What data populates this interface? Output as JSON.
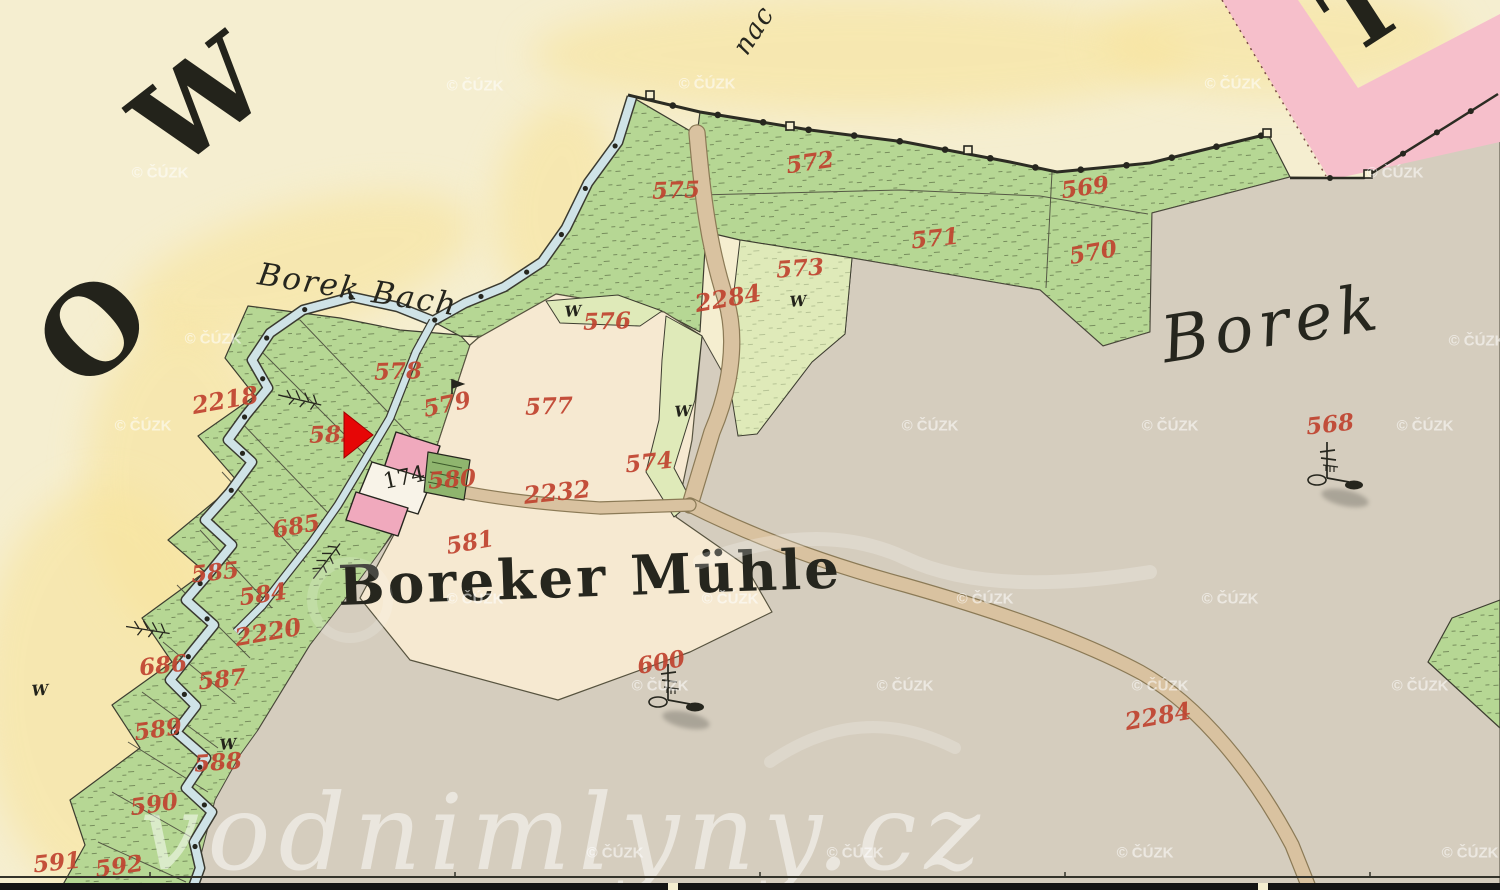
{
  "viewer": {
    "copyright_watermark": {
      "text": "© ČÚZK",
      "positions": [
        [
          475,
          85
        ],
        [
          707,
          83
        ],
        [
          1233,
          83
        ],
        [
          160,
          172
        ],
        [
          1395,
          172
        ],
        [
          213,
          338
        ],
        [
          1477,
          340
        ],
        [
          143,
          425
        ],
        [
          930,
          425
        ],
        [
          1170,
          425
        ],
        [
          1425,
          425
        ],
        [
          475,
          598
        ],
        [
          730,
          598
        ],
        [
          985,
          598
        ],
        [
          1230,
          598
        ],
        [
          660,
          685
        ],
        [
          905,
          685
        ],
        [
          1160,
          685
        ],
        [
          1420,
          685
        ],
        [
          615,
          852
        ],
        [
          855,
          852
        ],
        [
          1145,
          852
        ],
        [
          1470,
          852
        ]
      ]
    },
    "site_watermark": {
      "text": "vodnimlyny.cz",
      "x": 140,
      "y": 832
    },
    "marker": {
      "type": "right-arrow",
      "color": "#e60606",
      "points": [
        [
          344,
          412
        ],
        [
          344,
          458
        ],
        [
          373,
          435
        ]
      ]
    }
  },
  "map": {
    "territory_letters": [
      {
        "t": "O",
        "x": 93,
        "y": 330,
        "r": -44,
        "s": 118
      },
      {
        "t": "W",
        "x": 200,
        "y": 102,
        "r": -38,
        "s": 115
      },
      {
        "t": "T",
        "x": 1363,
        "y": 10,
        "r": -33,
        "s": 95
      }
    ],
    "place_labels": [
      {
        "t": "Borek Bach",
        "x": 358,
        "y": 289,
        "r": 9,
        "s": 31,
        "it": 1,
        "ls": 2
      },
      {
        "t": "nac",
        "x": 753,
        "y": 30,
        "r": -57,
        "s": 27,
        "it": 1,
        "ls": 1
      },
      {
        "t": "Boreker Mühle",
        "x": 590,
        "y": 577,
        "r": -2,
        "s": 55,
        "b": 1,
        "ls": 3
      },
      {
        "t": "Borek",
        "x": 1272,
        "y": 323,
        "r": -9,
        "s": 64,
        "it": 1,
        "ls": 6
      }
    ],
    "house_numbers": [
      {
        "t": "174",
        "x": 404,
        "y": 477,
        "r": -12,
        "s": 22
      }
    ],
    "parcel_numbers": [
      {
        "t": "2218",
        "x": 225,
        "y": 400,
        "r": -10
      },
      {
        "t": "572",
        "x": 810,
        "y": 162,
        "r": -8
      },
      {
        "t": "575",
        "x": 676,
        "y": 190,
        "r": -2
      },
      {
        "t": "569",
        "x": 1085,
        "y": 187,
        "r": -8
      },
      {
        "t": "571",
        "x": 935,
        "y": 238,
        "r": -6
      },
      {
        "t": "570",
        "x": 1093,
        "y": 252,
        "r": -10
      },
      {
        "t": "573",
        "x": 800,
        "y": 268,
        "r": -4
      },
      {
        "t": "2284",
        "x": 728,
        "y": 298,
        "r": -10
      },
      {
        "t": "576",
        "x": 607,
        "y": 321,
        "r": -2
      },
      {
        "t": "578",
        "x": 398,
        "y": 371,
        "r": -2
      },
      {
        "t": "579",
        "x": 447,
        "y": 404,
        "r": -12
      },
      {
        "t": "577",
        "x": 549,
        "y": 406,
        "r": -2
      },
      {
        "t": "582",
        "x": 333,
        "y": 434,
        "r": -2
      },
      {
        "t": "574",
        "x": 649,
        "y": 462,
        "r": -6
      },
      {
        "t": "580",
        "x": 452,
        "y": 479,
        "r": -4
      },
      {
        "t": "2232",
        "x": 557,
        "y": 492,
        "r": -6
      },
      {
        "t": "581",
        "x": 470,
        "y": 542,
        "r": -10
      },
      {
        "t": "685",
        "x": 296,
        "y": 526,
        "r": -10
      },
      {
        "t": "585",
        "x": 215,
        "y": 572,
        "r": -6
      },
      {
        "t": "584",
        "x": 263,
        "y": 594,
        "r": -8
      },
      {
        "t": "2220",
        "x": 268,
        "y": 632,
        "r": -10
      },
      {
        "t": "686",
        "x": 163,
        "y": 665,
        "r": -6
      },
      {
        "t": "587",
        "x": 222,
        "y": 679,
        "r": -6
      },
      {
        "t": "589",
        "x": 158,
        "y": 729,
        "r": -8
      },
      {
        "t": "588",
        "x": 218,
        "y": 762,
        "r": -4
      },
      {
        "t": "590",
        "x": 154,
        "y": 804,
        "r": -8
      },
      {
        "t": "591",
        "x": 57,
        "y": 862,
        "r": -6
      },
      {
        "t": "592",
        "x": 119,
        "y": 866,
        "r": -8
      },
      {
        "t": "600",
        "x": 661,
        "y": 662,
        "r": -10
      },
      {
        "t": "568",
        "x": 1330,
        "y": 424,
        "r": -6
      },
      {
        "t": "2284",
        "x": 1158,
        "y": 716,
        "r": -10
      }
    ],
    "meadow_symbols": {
      "glyph": "W",
      "positions": [
        [
          573,
          311
        ],
        [
          683,
          411
        ],
        [
          798,
          301
        ],
        [
          228,
          744
        ],
        [
          40,
          690
        ]
      ]
    },
    "trig_points": [
      [
        668,
        700
      ],
      [
        1327,
        478
      ]
    ],
    "colors": {
      "paper": "#f5eed0",
      "halo_yellow": "#f8e49d",
      "meadow_green": "#b6d794",
      "meadow_light": "#dfeab9",
      "field_grey": "#d5cdbe",
      "farmland_beige": "#f6e9d1",
      "road_pink": "#f6bfcb",
      "road_tan": "#d9c2a0",
      "stream_blue": "#cfe3e7",
      "building_pink": "#f0a9bd",
      "garden_green": "#8fb56e",
      "ink": "#2c2c23",
      "number_red": "#c0432f"
    }
  }
}
